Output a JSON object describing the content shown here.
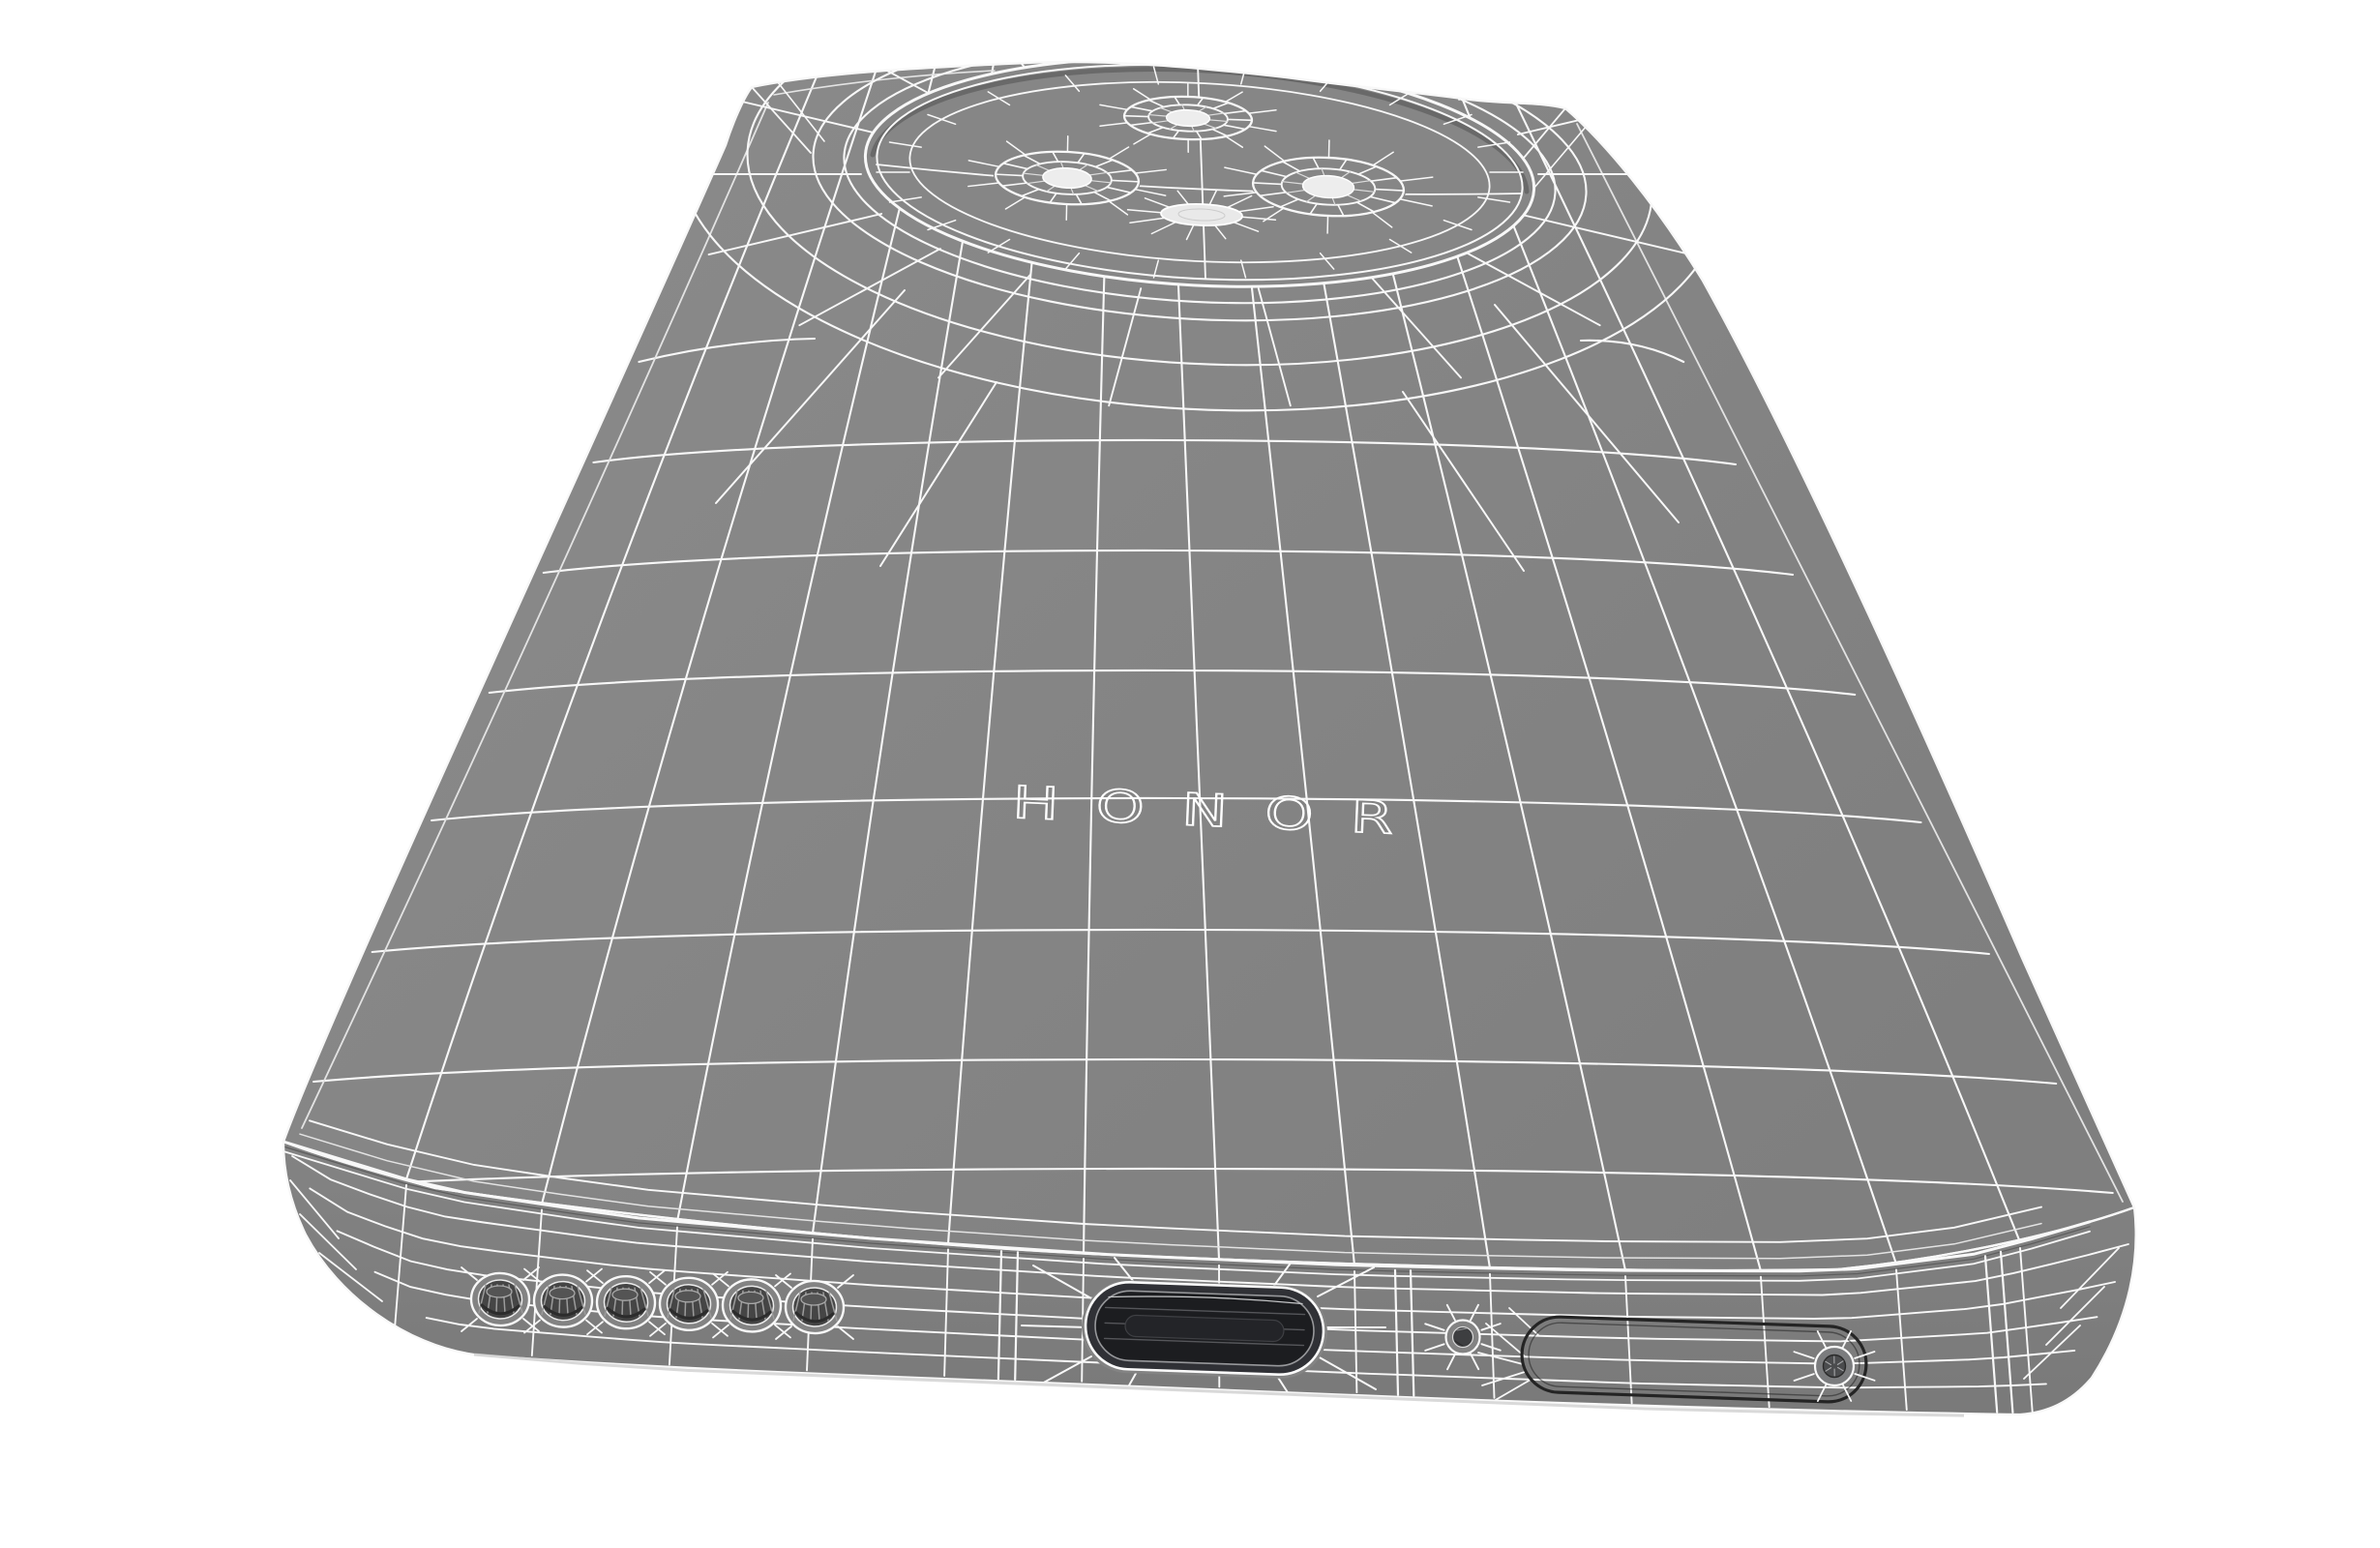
{
  "meta": {
    "description": "3D wireframe render of an HONOR smartphone viewed from the rear bottom, lying flat",
    "view": "rear-bottom perspective"
  },
  "logo": {
    "text": "HONOR"
  },
  "colors": {
    "background": "#ffffff",
    "body": "#868686",
    "body_edge": "#7f7f7f",
    "band_top": "#838383",
    "band_bottom": "#797979",
    "wire": "#f8f8f8",
    "wire_soft": "#e3e3e3",
    "step_shadow": "#696969",
    "hole_dark": "#454545",
    "hole_lines": "#9b9b9b",
    "usb_dark": "#1c1d20",
    "usb_mid": "#303136",
    "usb_lines": "#55565a",
    "lens_core": "#ededed",
    "flash_fill": "#e9e9e9",
    "sim_outline": "#242424",
    "eject_fill": "#7b7c7e"
  },
  "camera_module": {
    "lens_count": 3,
    "flash_count": 1
  },
  "bottom_edge": {
    "speaker_hole_count": 6,
    "has_usb_c_port": true,
    "has_microphone_hole": true,
    "has_sim_tray": true,
    "has_sim_eject_hole": true
  }
}
